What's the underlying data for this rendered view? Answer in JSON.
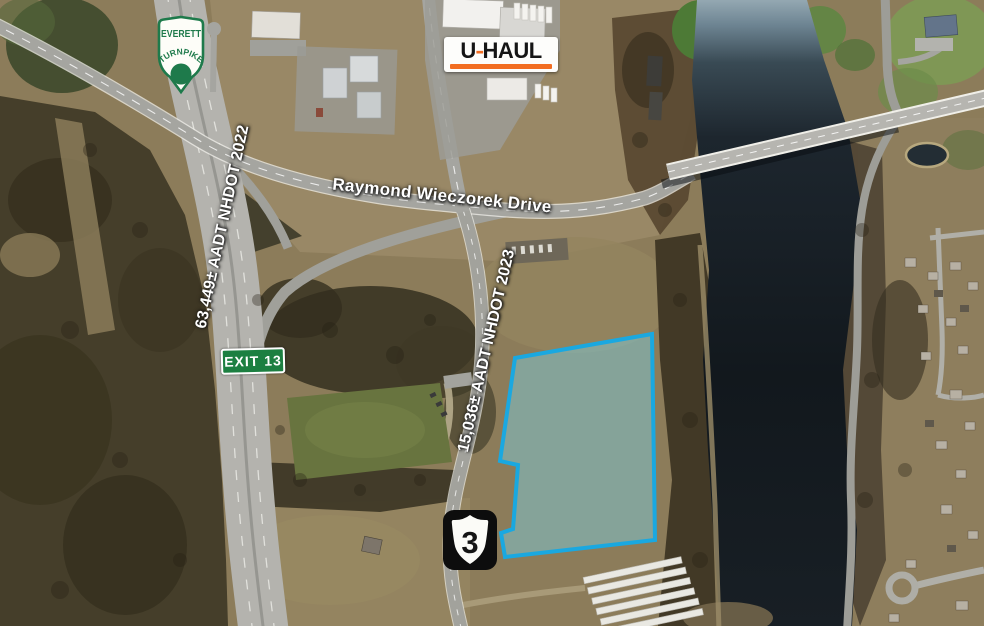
{
  "signs": {
    "everett_shield": {
      "top": "EVERETT",
      "arc": "TURNPIKE"
    },
    "uhaul_logo": {
      "u": "U",
      "dash": "-",
      "haul": "HAUL"
    },
    "exit_sign": "EXIT 13",
    "route_shield": "3"
  },
  "labels": {
    "road_name": "Raymond Wieczorek Drive",
    "turnpike_aadt": "63,449± AADT NHDOT 2022",
    "route3_aadt": "15,036± AADT NHDOT 2023"
  },
  "parcel": {
    "outline_color": "#1aa8e0",
    "fill_color": "rgba(125,202,216,0.5)"
  },
  "colors": {
    "exit_sign_green": "#1c7f41",
    "shield_green": "#1e7a4b",
    "uhaul_orange": "#f26d21",
    "river_dark": "#12181d"
  }
}
